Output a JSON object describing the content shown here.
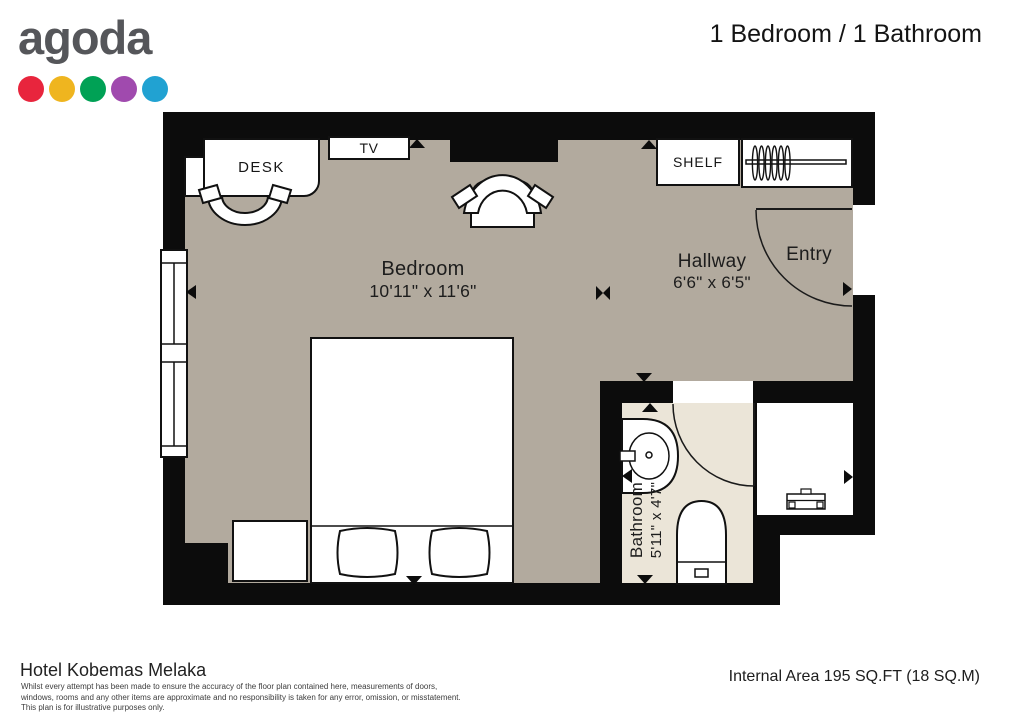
{
  "header": {
    "logo_text": "agoda",
    "dot_colors": [
      "#e8253d",
      "#efb51f",
      "#00a155",
      "#a04aae",
      "#21a2d2"
    ],
    "title": "1 Bedroom / 1 Bathroom"
  },
  "plan": {
    "bedroom": {
      "name": "Bedroom",
      "dims": "10'11\" x 11'6\""
    },
    "hallway": {
      "name": "Hallway",
      "dims": "6'6\" x 6'5\""
    },
    "bathroom": {
      "name": "Bathroom",
      "dims": "5'11\" x 4'7\""
    },
    "entry": {
      "name": "Entry"
    },
    "furniture": {
      "desk": "DESK",
      "tv": "TV",
      "shelf": "SHELF"
    },
    "colors": {
      "wall": "#0c0c0c",
      "floor": "#b2aa9e",
      "bathroom_floor": "#ebe5d8"
    }
  },
  "footer": {
    "hotel_name": "Hotel Kobemas Melaka",
    "disclaimer_lines": [
      "Whilst every attempt has been made to ensure the accuracy of the floor plan contained here, measurements of doors,",
      "windows, rooms and any other items are approximate and no responsibility is taken for any error, omission, or misstatement.",
      "This plan is for illustrative purposes only."
    ],
    "area_text": "Internal Area 195 SQ.FT (18 SQ.M)"
  }
}
